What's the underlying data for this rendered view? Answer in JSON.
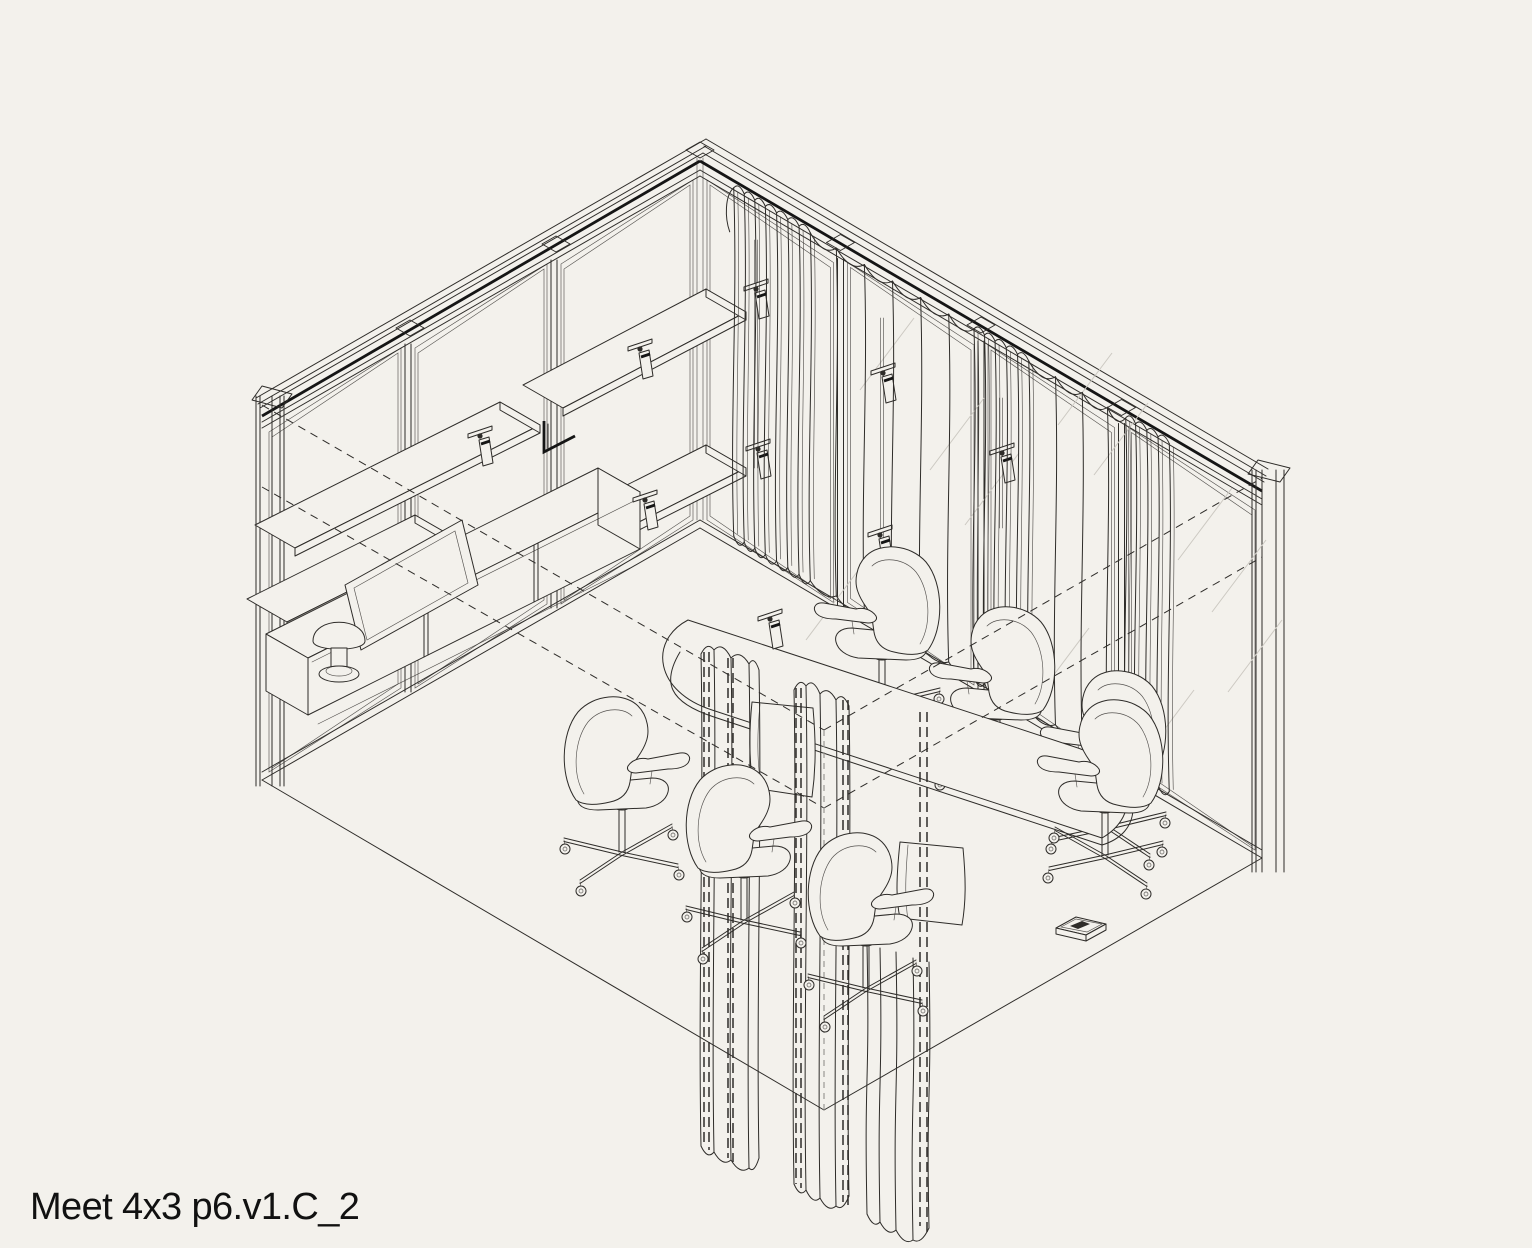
{
  "title": "Meet 4x3 p6.v1.C_2",
  "colors": {
    "background": "#f3f1ec",
    "line": "#2e2c29",
    "dark_accent": "#151515",
    "reflection": "#ccc9c2",
    "hidden_gray": "#9a9894",
    "text": "#111111"
  },
  "drawing": {
    "type": "isometric-room",
    "room_label": "Meet 4x3",
    "version_label": "p6.v1.C_2",
    "elements": [
      "glass-partition-left-wall",
      "glass-partition-right-wall",
      "wavy-curtain-right-wall",
      "front-divider-curtain",
      "oval-meeting-table",
      "office-swivel-chairs",
      "staggered-wall-shelves",
      "credenza-cabinet",
      "mushroom-table-lamp",
      "leaning-picture-frame",
      "track-spotlights",
      "floor-outlet-box"
    ],
    "chairs_count": 7,
    "spotlights_count": 9,
    "left_wall_panels": 3,
    "right_wall_panels": 4
  }
}
